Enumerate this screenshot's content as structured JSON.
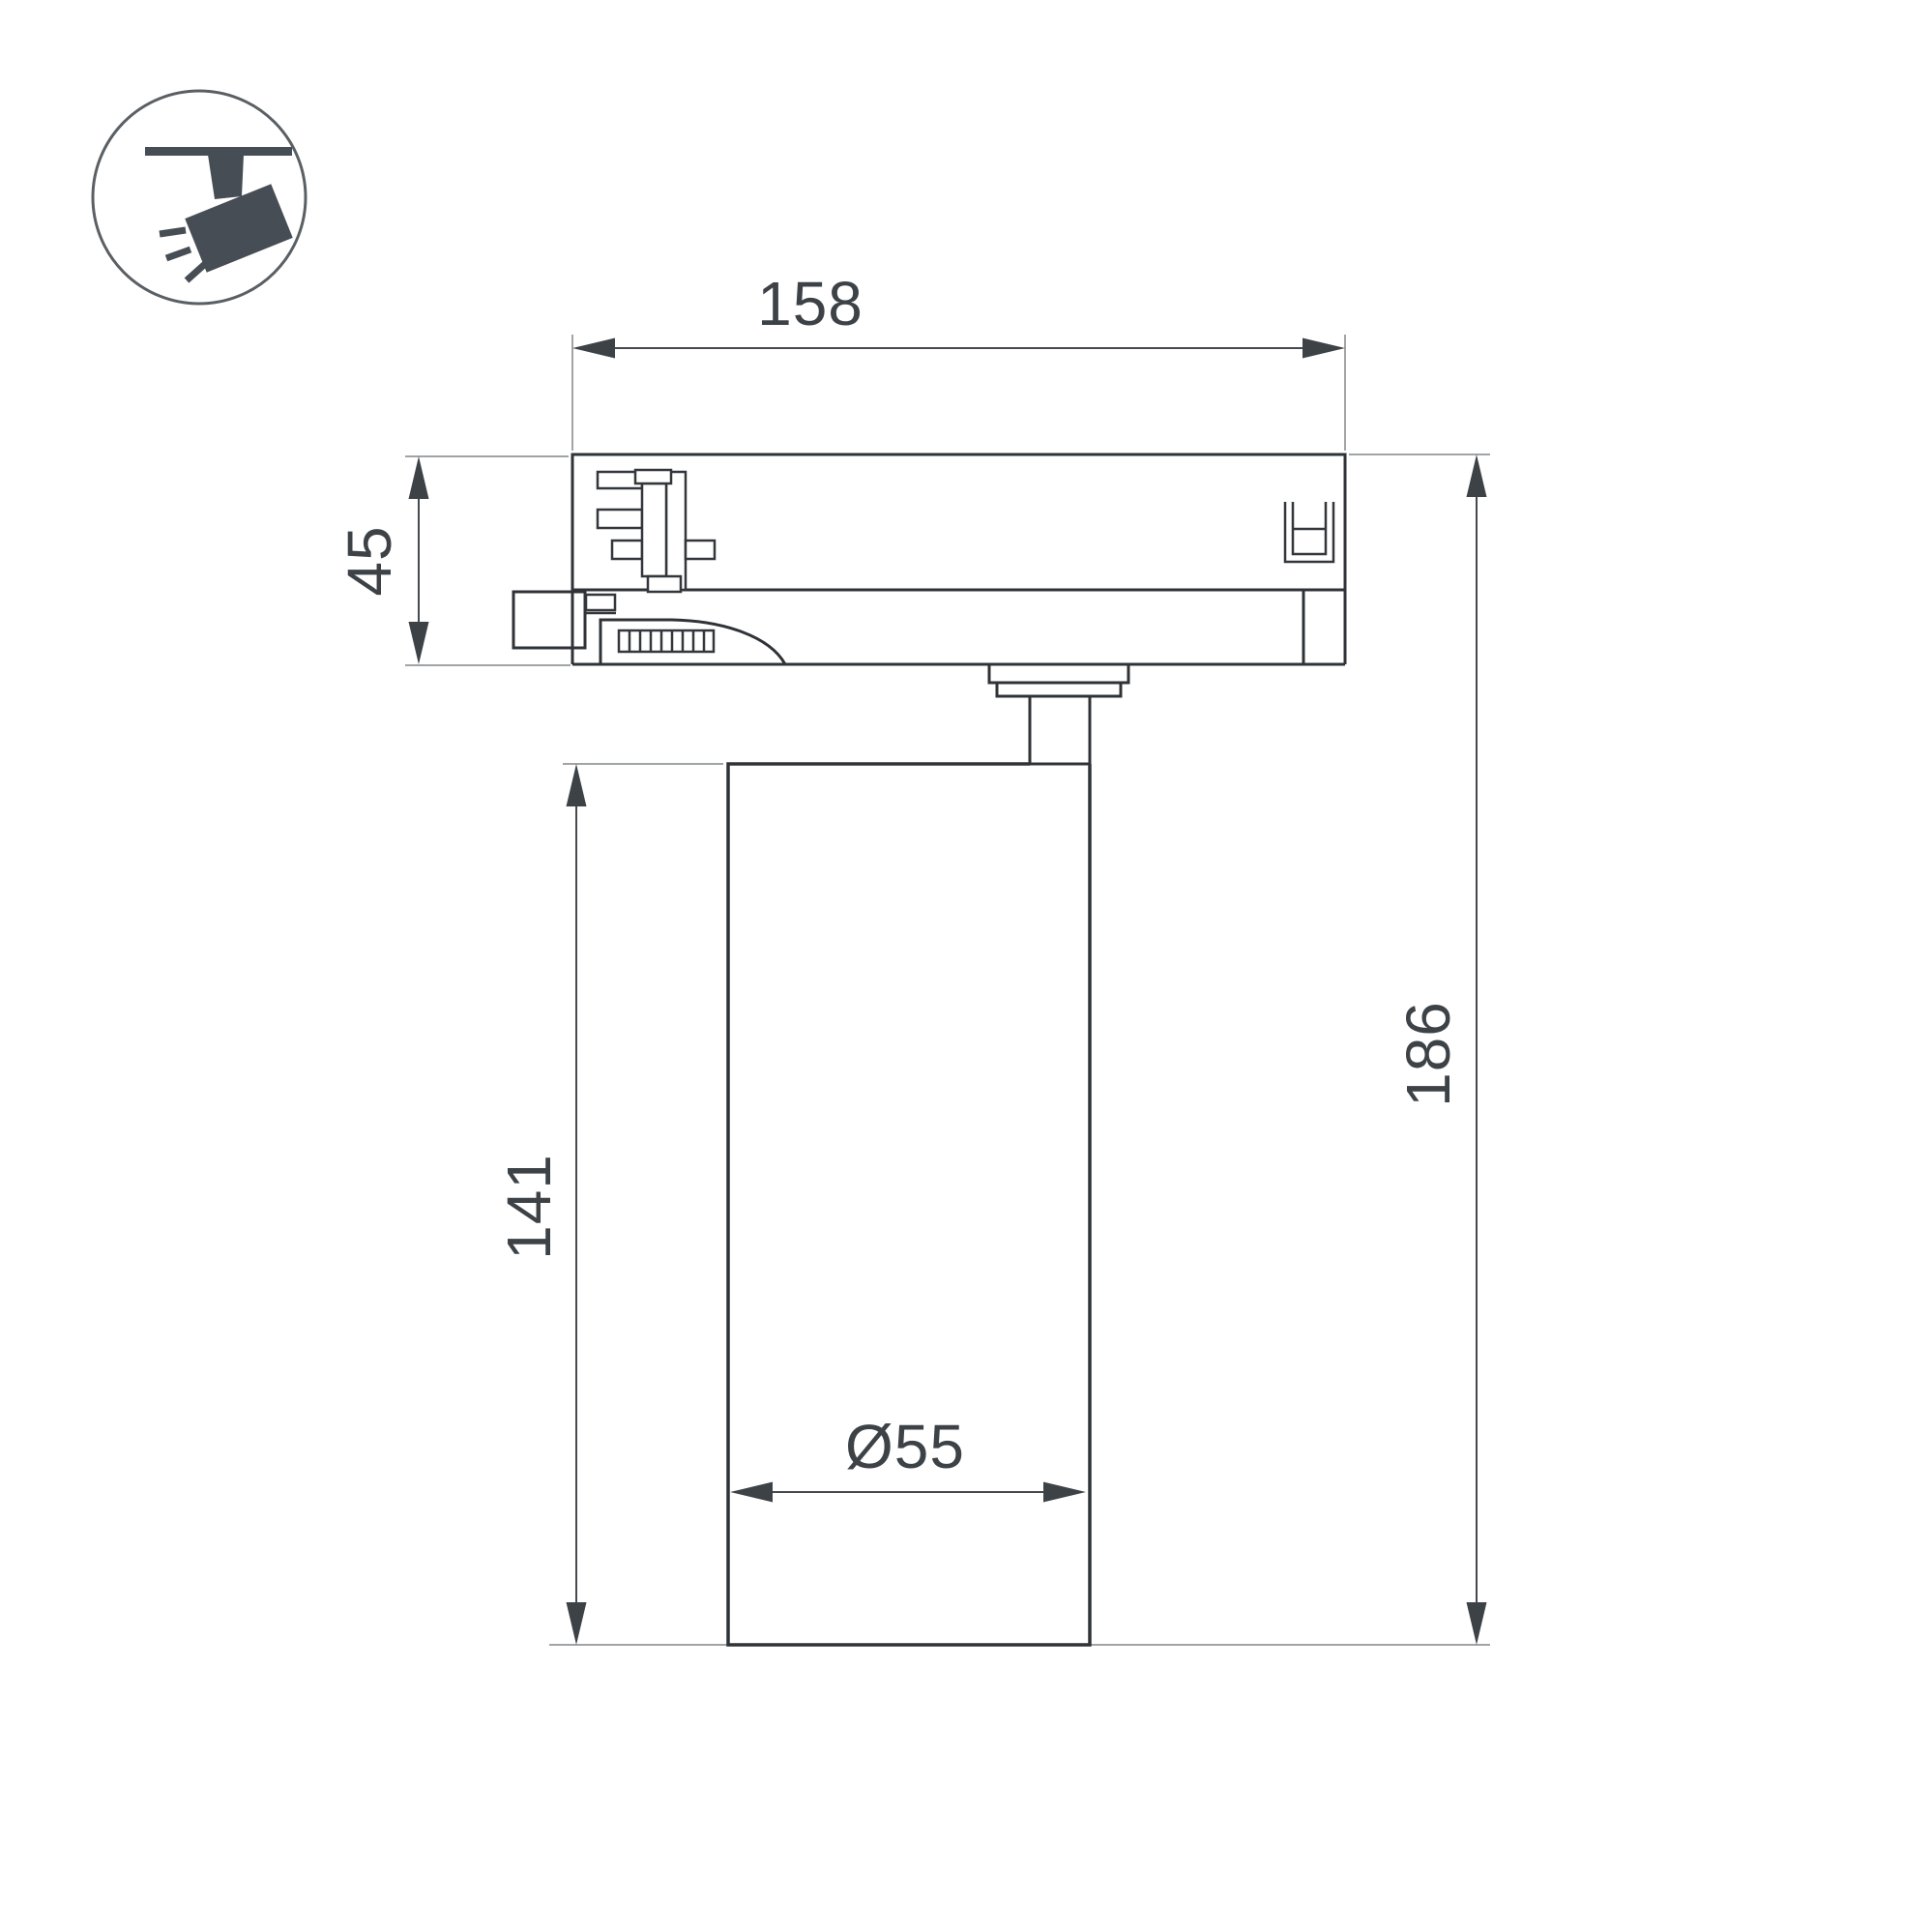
{
  "drawing": {
    "dimensions": {
      "adapter_width": "158",
      "adapter_height": "45",
      "body_height": "141",
      "total_height": "186",
      "body_diameter": "Ø55"
    },
    "colors": {
      "outline": "#2f3337",
      "detail_outline": "#33373b",
      "dimension_line": "#46494d",
      "extension_line": "#828587",
      "label_text": "#3d4247",
      "icon": "#474d54",
      "icon_circle": "#5a5f63",
      "background": "#ffffff"
    },
    "icon": {
      "name": "track-spotlight-icon"
    }
  }
}
